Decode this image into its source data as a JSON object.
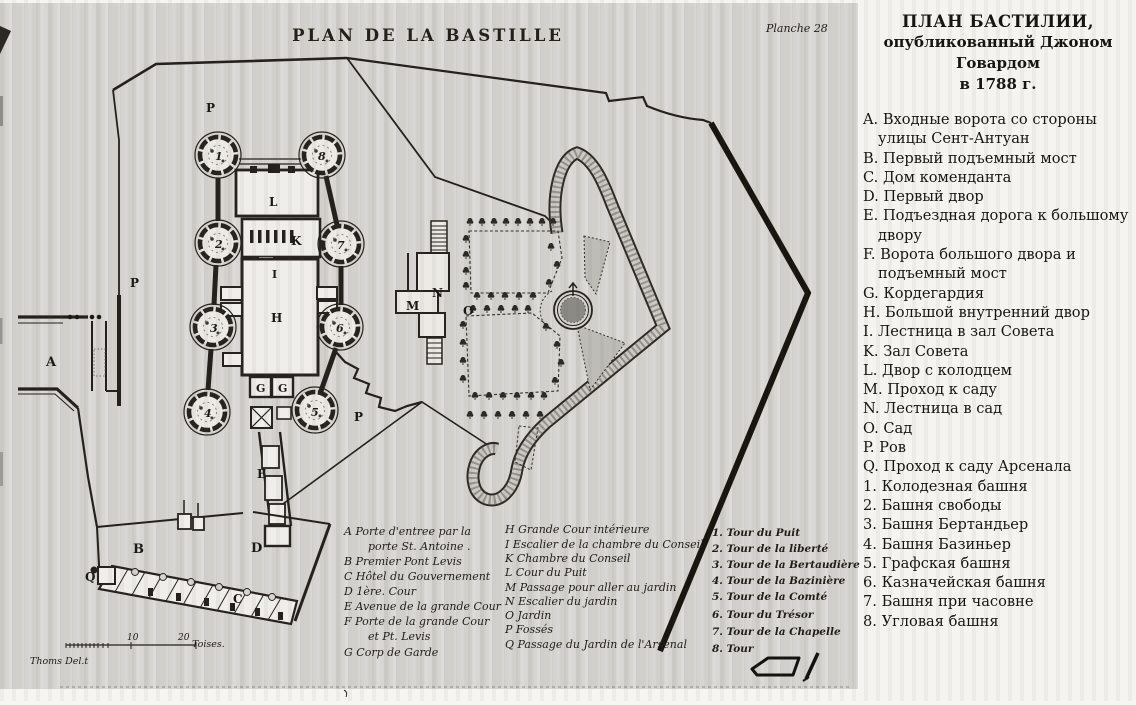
{
  "plate": {
    "title": "PLAN DE LA BASTILLE",
    "number": "Planche 28",
    "signature": "Thoms Del.t",
    "scale": {
      "t10": "10",
      "t20": "20",
      "unit": "Toises."
    }
  },
  "map_labels": {
    "p_top": "P",
    "p_left": "P",
    "p_bottom": "P",
    "a": "A",
    "b": "B",
    "c": "C",
    "d": "D",
    "e": "E",
    "g_left": "G",
    "g_right": "G",
    "h": "H",
    "i": "I",
    "k": "K",
    "l": "L",
    "m": "M",
    "n": "N",
    "o": "O",
    "q": "Q",
    "t1": "1",
    "t2": "2",
    "t3": "3",
    "t4": "4",
    "t5": "5",
    "t6": "6",
    "t7": "7",
    "t8": "8"
  },
  "legend_fr": {
    "col1": [
      "A Porte d'entree par la",
      "porte St. Antoine .",
      "B Premier Pont Levis",
      "C Hôtel du Gouvernement",
      "D 1ère. Cour",
      "E Avenue de la grande Cour",
      "F Porte de la grande Cour",
      "et Pt. Levis",
      "G Corp de Garde"
    ],
    "col2": [
      "H Grande Cour intérieure",
      "I Escalier de la chambre du Conseil",
      "K Chambre du Conseil",
      "L Cour du Puit",
      "M Passage pour aller au jardin",
      "N Escalier du jardin",
      "O Jardin",
      "P Fossés",
      "Q Passage du Jardin de l'Arsenal"
    ],
    "col3": [
      "1. Tour du Puit",
      "2. Tour de la liberté",
      "3. Tour de la Bertaudière",
      "4. Tour de la Bazinière",
      "5. Tour de la Comté",
      "6. Tour du Trésor",
      "7. Tour de la Chapelle",
      "8. Tour"
    ]
  },
  "sidebar": {
    "title_lines": [
      "ПЛАН БАСТИЛИИ,",
      "опубликованный Джоном Говардом",
      "в 1788 г."
    ],
    "entries": [
      {
        "key": "A.",
        "text": "Входные ворота со стороны улицы Сент-Антуан"
      },
      {
        "key": "B.",
        "text": "Первый подъемный мост"
      },
      {
        "key": "C.",
        "text": "Дом коменданта"
      },
      {
        "key": "D.",
        "text": "Первый двор"
      },
      {
        "key": "E.",
        "text": "Подъездная дорога к большому двору"
      },
      {
        "key": "F.",
        "text": "Ворота большого двора и подъемный мост"
      },
      {
        "key": "G.",
        "text": "Кордегардия"
      },
      {
        "key": "H.",
        "text": "Большой внутренний двор"
      },
      {
        "key": "I.",
        "text": "Лестница в зал Совета"
      },
      {
        "key": "K.",
        "text": "Зал Совета"
      },
      {
        "key": "L.",
        "text": "Двор с колодцем"
      },
      {
        "key": "M.",
        "text": "Проход к саду"
      },
      {
        "key": "N.",
        "text": "Лестница в сад"
      },
      {
        "key": "O.",
        "text": "Сад"
      },
      {
        "key": "P.",
        "text": "Ров"
      },
      {
        "key": "Q.",
        "text": "Проход к саду Арсенала"
      },
      {
        "key": "1.",
        "text": "Колодезная башня"
      },
      {
        "key": "2.",
        "text": "Башня свободы"
      },
      {
        "key": "3.",
        "text": "Башня Бертандьер"
      },
      {
        "key": "4.",
        "text": "Башня Базиньер"
      },
      {
        "key": "5.",
        "text": "Графская башня"
      },
      {
        "key": "6.",
        "text": "Казначейская башня"
      },
      {
        "key": "7.",
        "text": "Башня при часовне"
      },
      {
        "key": "8.",
        "text": "Угловая башня"
      }
    ]
  }
}
